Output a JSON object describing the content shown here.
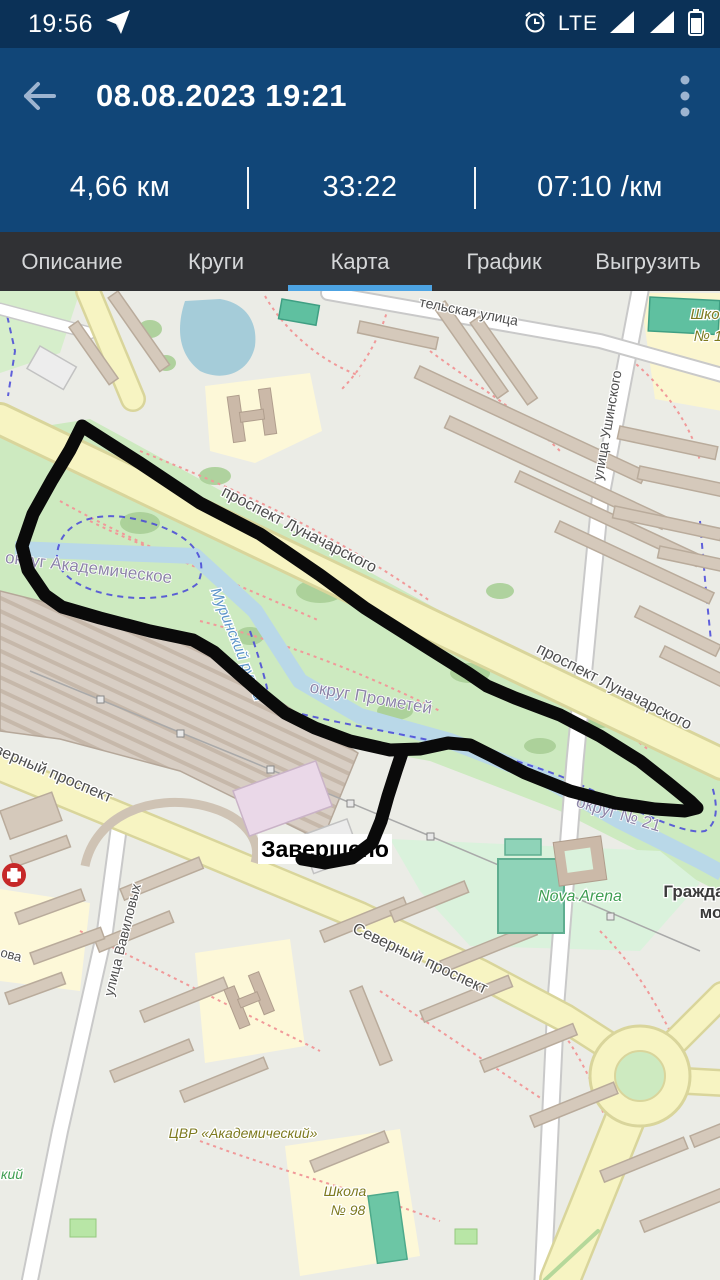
{
  "status_bar": {
    "time": "19:56",
    "network": "LTE"
  },
  "app_bar": {
    "title": "08.08.2023 19:21"
  },
  "stats": {
    "distance": "4,66 км",
    "duration": "33:22",
    "pace": "07:10 /км"
  },
  "tabs": {
    "items": [
      "Описание",
      "Круги",
      "Карта",
      "График",
      "Выгрузить"
    ],
    "active": "Карта"
  },
  "colors": {
    "status_bar_bg": "#0b3157",
    "app_bar_bg": "#114678",
    "tab_bar_bg": "#303134",
    "tab_accent": "#4da3e2",
    "track": "#0a0a0a",
    "park_green": "#cdeac0",
    "road_yellow": "#f7f4c2",
    "water_blue": "#b9d8e8"
  },
  "map": {
    "finish": {
      "label": "Завершено"
    },
    "track": {
      "main": "82,135 140,172 200,212 260,243 320,284 365,317 425,355 468,382 487,395 515,407 560,424 600,445 640,470 668,492 690,510 697,517 685,520 655,518 615,512 570,500 525,482 492,465 470,454 448,452 420,458 390,459 350,450 315,437 285,422 263,404 240,384 214,361 193,349 150,340 100,327 62,316 45,304 28,279 22,255 33,223 52,189 70,159 82,135",
      "finish_branch": "403,459 396,480 388,505 381,530 372,552 352,567 325,572 302,568"
    },
    "labels": [
      {
        "t": "проспект Луначарского",
        "x": 297,
        "y": 243,
        "r": 27,
        "c": "street",
        "s": 16
      },
      {
        "t": "проспект Луначарского",
        "x": 612,
        "y": 400,
        "r": 27,
        "c": "street",
        "s": 16
      },
      {
        "t": "Северный проспект",
        "x": 42,
        "y": 483,
        "r": 23,
        "c": "street",
        "s": 16
      },
      {
        "t": "Северный проспект",
        "x": 418,
        "y": 672,
        "r": 25,
        "c": "street",
        "s": 16
      },
      {
        "t": "округ Академическое",
        "x": 88,
        "y": 282,
        "r": 7,
        "c": "district",
        "s": 17
      },
      {
        "t": "округ Прометей",
        "x": 370,
        "y": 412,
        "r": 10,
        "c": "district",
        "s": 17
      },
      {
        "t": "округ № 21",
        "x": 617,
        "y": 528,
        "r": 17,
        "c": "district",
        "s": 17
      },
      {
        "t": "Муринский ручей",
        "x": 233,
        "y": 355,
        "r": 68,
        "c": "water",
        "s": 15
      },
      {
        "t": "улица Ушинского",
        "x": 612,
        "y": 135,
        "r": -80,
        "c": "street",
        "s": 14
      },
      {
        "t": "улица Вавиловых",
        "x": 127,
        "y": 650,
        "r": -76,
        "c": "street",
        "s": 14
      },
      {
        "t": "тельская улица",
        "x": 468,
        "y": 25,
        "r": 11,
        "c": "street",
        "s": 14
      },
      {
        "t": "Шко",
        "x": 705,
        "y": 28,
        "r": 0,
        "c": "school",
        "s": 15
      },
      {
        "t": "№ 1",
        "x": 708,
        "y": 50,
        "r": 0,
        "c": "school",
        "s": 15
      },
      {
        "t": "Nova Arena",
        "x": 580,
        "y": 610,
        "r": 0,
        "c": "green-poi",
        "s": 16
      },
      {
        "t": "Гражда",
        "x": 694,
        "y": 606,
        "r": 0,
        "c": "place",
        "s": 17
      },
      {
        "t": "мо",
        "x": 711,
        "y": 627,
        "r": 0,
        "c": "place",
        "s": 17
      },
      {
        "t": "ЦВР «Академический»",
        "x": 243,
        "y": 847,
        "r": 0,
        "c": "school",
        "s": 14
      },
      {
        "t": "Школа",
        "x": 345,
        "y": 905,
        "r": 0,
        "c": "school",
        "s": 14
      },
      {
        "t": "№ 98",
        "x": 348,
        "y": 924,
        "r": 0,
        "c": "school",
        "s": 14
      },
      {
        "t": "ова",
        "x": 10,
        "y": 668,
        "r": 15,
        "c": "street",
        "s": 13
      },
      {
        "t": "кий",
        "x": 12,
        "y": 888,
        "r": 0,
        "c": "green-poi",
        "s": 14
      }
    ]
  }
}
